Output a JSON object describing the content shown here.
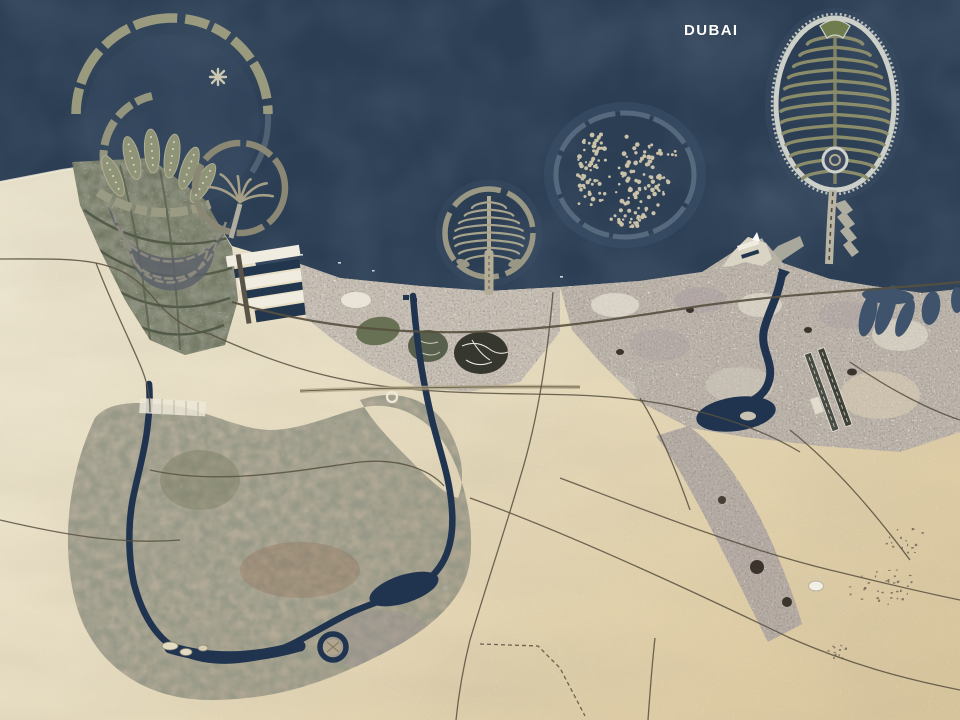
{
  "title_label": {
    "text": "DUBAI"
  },
  "colors": {
    "label": "#ffffff",
    "sea": "#2c3e54",
    "sea_shallow": "#3c536c",
    "sand_west": "#ece5cf",
    "sand_east": "#d9c69c",
    "inland_water": "#203450",
    "road": "#57503f",
    "urban_west": "#c7bfb4",
    "urban_east": "#bdb5ab",
    "development": "#68705c",
    "palm_structure": "#9a9a7f",
    "palm_frond": "#8a8c6a",
    "palm_rim": "#ccd0c9",
    "world_island": "#c9c1a8",
    "world_ring": "#5d7084",
    "dock_white": "#f0ece0"
  }
}
